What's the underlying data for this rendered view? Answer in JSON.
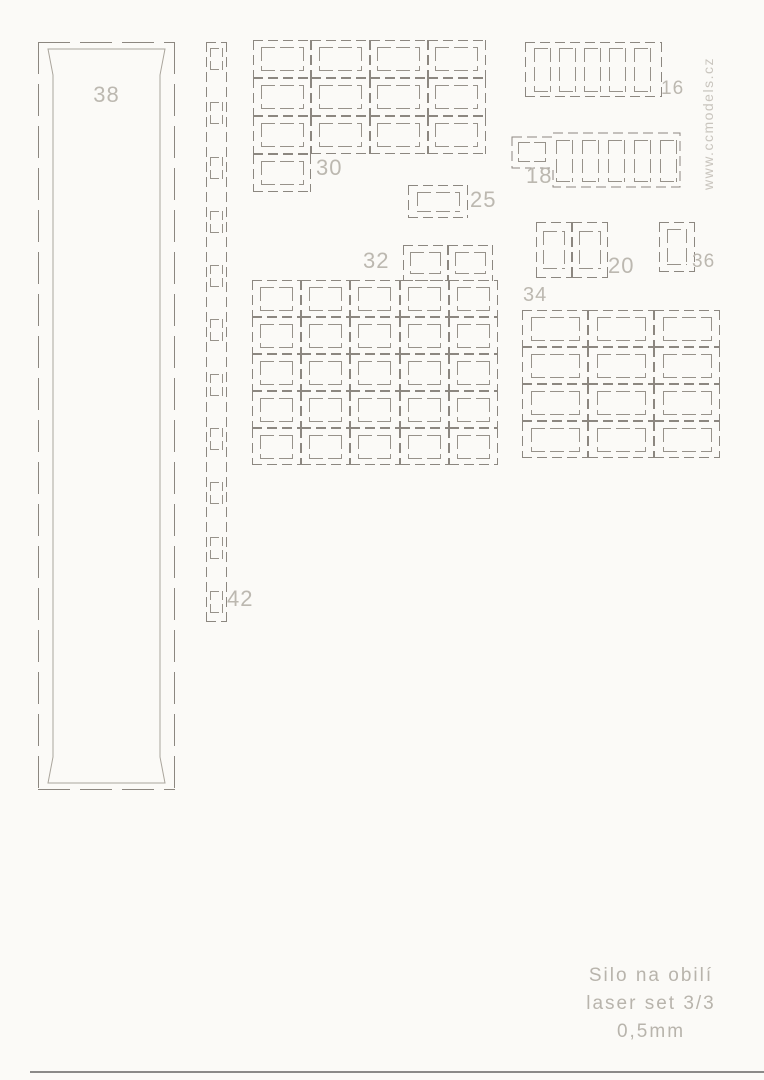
{
  "sheet": {
    "title_line1": "Silo na obilí",
    "title_line2": "laser set 3/3",
    "title_line3": "0,5mm",
    "watermark": "www.ccmodels.cz",
    "background_color": "#fbfaf7",
    "cut_line_color": "#8c8780",
    "label_color": "#bcb8b0"
  },
  "parts": {
    "p38": {
      "label": "38"
    },
    "p42": {
      "label": "42",
      "holes": 11
    },
    "p30": {
      "label": "30",
      "cells": 12,
      "cols": 4,
      "extra_cells": 1
    },
    "p25": {
      "label": "25",
      "cells": 1
    },
    "p32": {
      "label": "32",
      "cells": 25,
      "cols": 5,
      "top_cells": 2
    },
    "p16": {
      "label": "16",
      "slots": 5
    },
    "p18": {
      "label": "18",
      "slots": 5,
      "side_windows": 1
    },
    "p20": {
      "label": "20",
      "cells": 2
    },
    "p36": {
      "label": "36",
      "cells": 1
    },
    "p34": {
      "label": "34",
      "cells": 12,
      "cols": 3
    }
  }
}
